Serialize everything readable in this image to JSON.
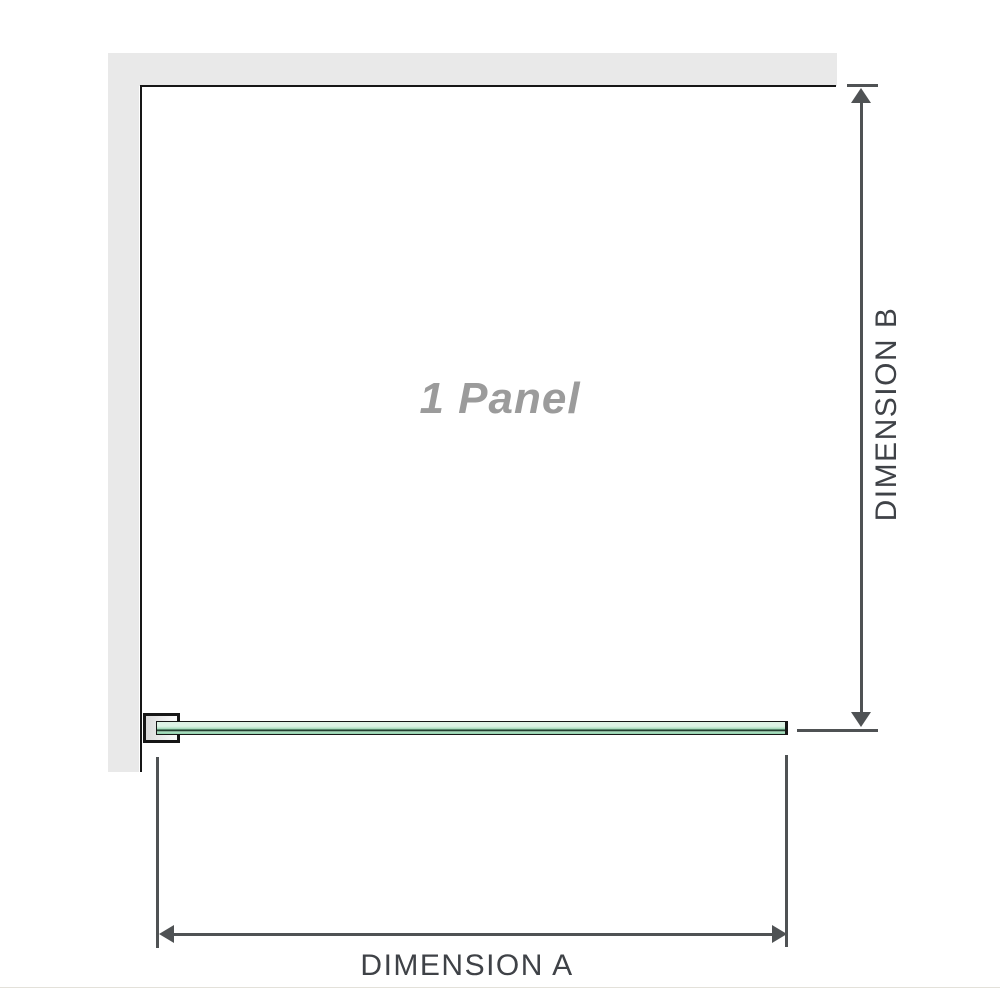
{
  "labels": {
    "panel_count": "1 Panel",
    "dimension_a": "DIMENSION A",
    "dimension_b": "DIMENSION B"
  },
  "colors": {
    "wall_fill": "#e9e9e9",
    "outline": "#161616",
    "glass_green_light": "#ddf2e5",
    "glass_green_mid": "#b4e2c7",
    "glass_green_deep": "#8fd0ab",
    "glass_dark_streak": "#223c2e",
    "dim_line": "#4f5254",
    "dim_text": "#3f4247",
    "panel_text": "#9b9b9b",
    "footer_rule": "#e3e1da"
  }
}
